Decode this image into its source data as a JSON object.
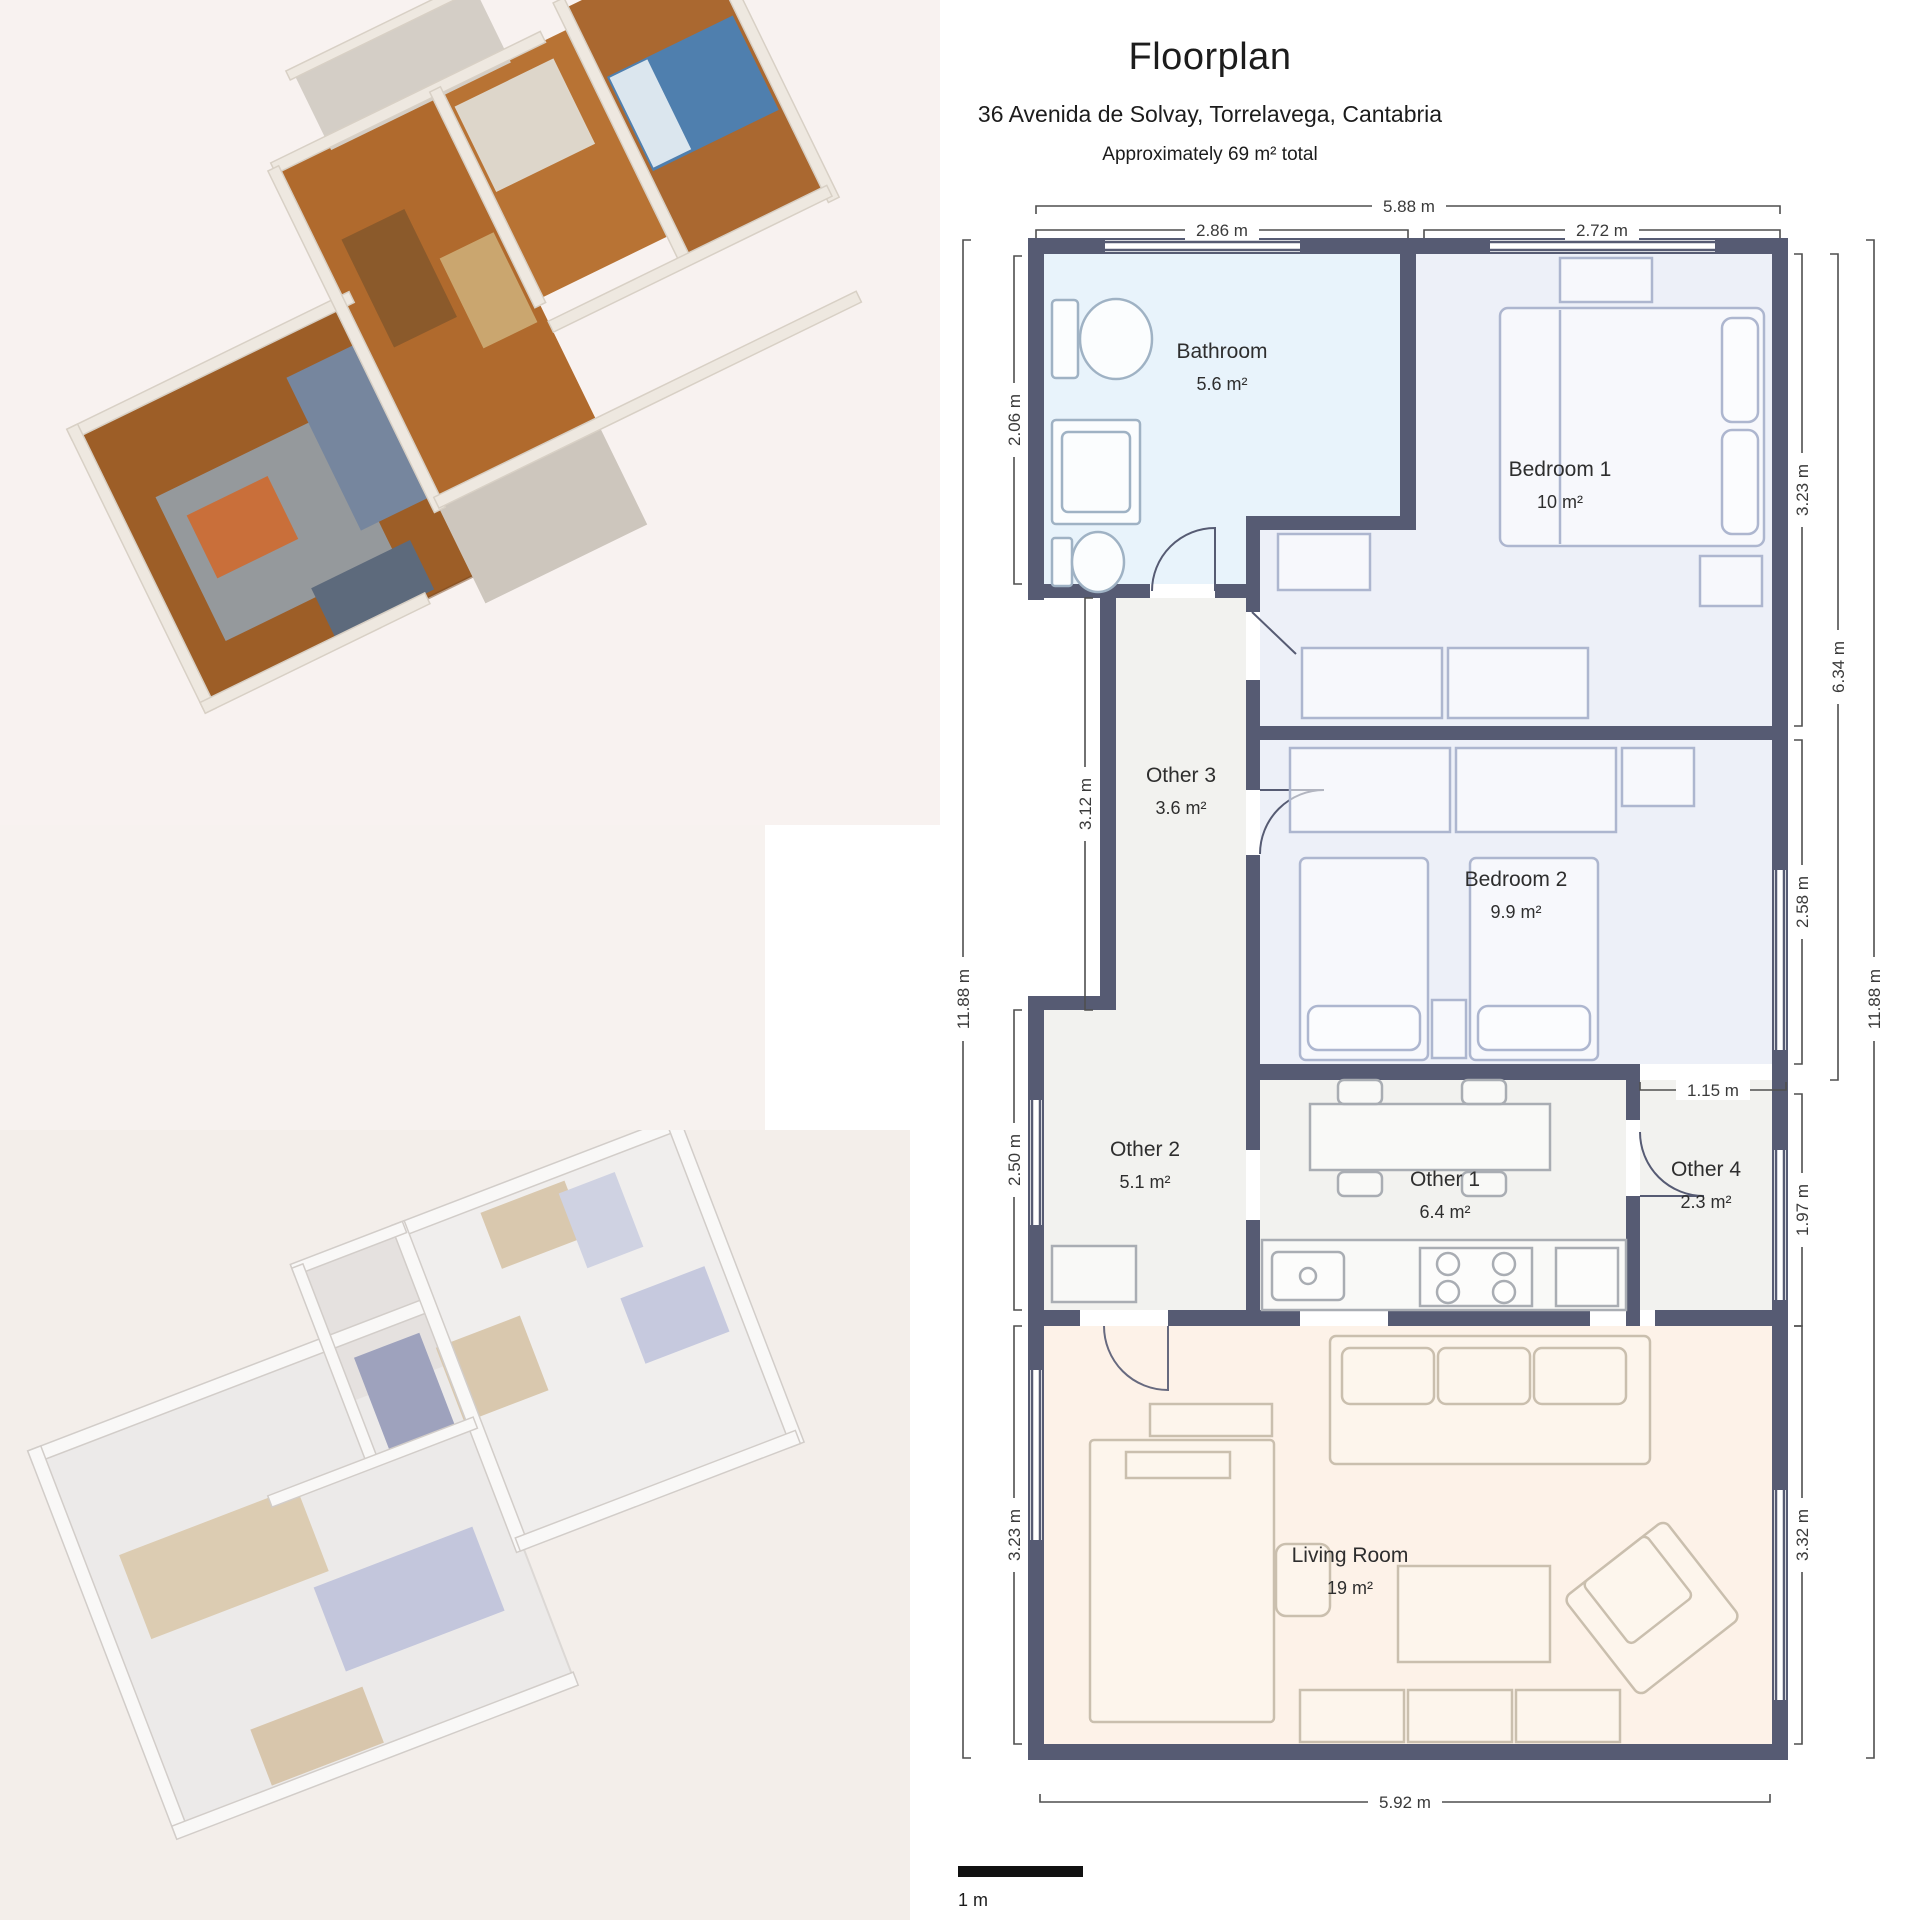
{
  "header": {
    "title": "Floorplan",
    "address": "36 Avenida de Solvay, Torrelavega, Cantabria",
    "subtitle": "Approximately 69 m² total"
  },
  "rooms": {
    "bathroom": {
      "name": "Bathroom",
      "area": "5.6 m²"
    },
    "bedroom1": {
      "name": "Bedroom 1",
      "area": "10 m²"
    },
    "other3": {
      "name": "Other 3",
      "area": "3.6 m²"
    },
    "bedroom2": {
      "name": "Bedroom 2",
      "area": "9.9 m²"
    },
    "other2": {
      "name": "Other 2",
      "area": "5.1 m²"
    },
    "other1": {
      "name": "Other 1",
      "area": "6.4 m²"
    },
    "other4": {
      "name": "Other 4",
      "area": "2.3 m²"
    },
    "living": {
      "name": "Living Room",
      "area": "19 m²"
    }
  },
  "dimensions": {
    "top_total": "5.88 m",
    "top_bathroom": "2.86 m",
    "top_bedroom1": "2.72 m",
    "left_bathroom": "2.06 m",
    "left_hallway": "3.12 m",
    "left_other2": "2.50 m",
    "left_living": "3.23 m",
    "left_total": "11.88 m",
    "right_bedroom1": "3.23 m",
    "right_bedrooms": "6.34 m",
    "right_bedroom2": "2.58 m",
    "right_other4": "1.97 m",
    "right_living": "3.32 m",
    "right_total": "11.88 m",
    "passage": "1.15 m",
    "bottom_total": "5.92 m"
  },
  "scale_bar": {
    "label": "1 m"
  },
  "colors": {
    "wall": "#565b73",
    "bathroom_fill": "#e8f3fb",
    "bedroom_fill": "#edf0f8",
    "other_fill": "#f2f2ef",
    "living_fill": "#fdf2e8",
    "dimension_line": "#4f4f4f"
  }
}
